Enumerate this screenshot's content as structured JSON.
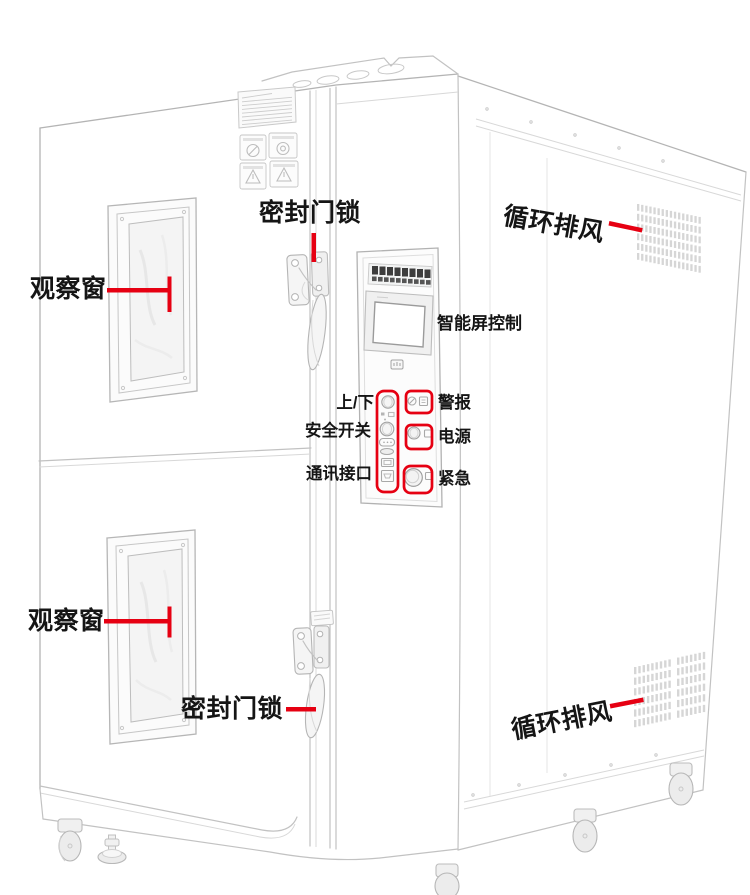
{
  "diagram": {
    "accent_color": "#e60012",
    "label_color": "#151515",
    "subject": "environmental-test-chamber-line-art",
    "annotations": {
      "observation_window_top": "观察窗",
      "observation_window_bottom": "观察窗",
      "door_lock_top": "密封门锁",
      "door_lock_bottom": "密封门锁",
      "circulating_vent_top": "循环排风",
      "circulating_vent_bottom": "循环排风",
      "smart_screen": "智能屏控制",
      "up_down": "上/下",
      "safety_switch": "安全开关",
      "comm_interface": "通讯接口",
      "alarm": "警报",
      "power": "电源",
      "emergency": "紧急"
    }
  }
}
